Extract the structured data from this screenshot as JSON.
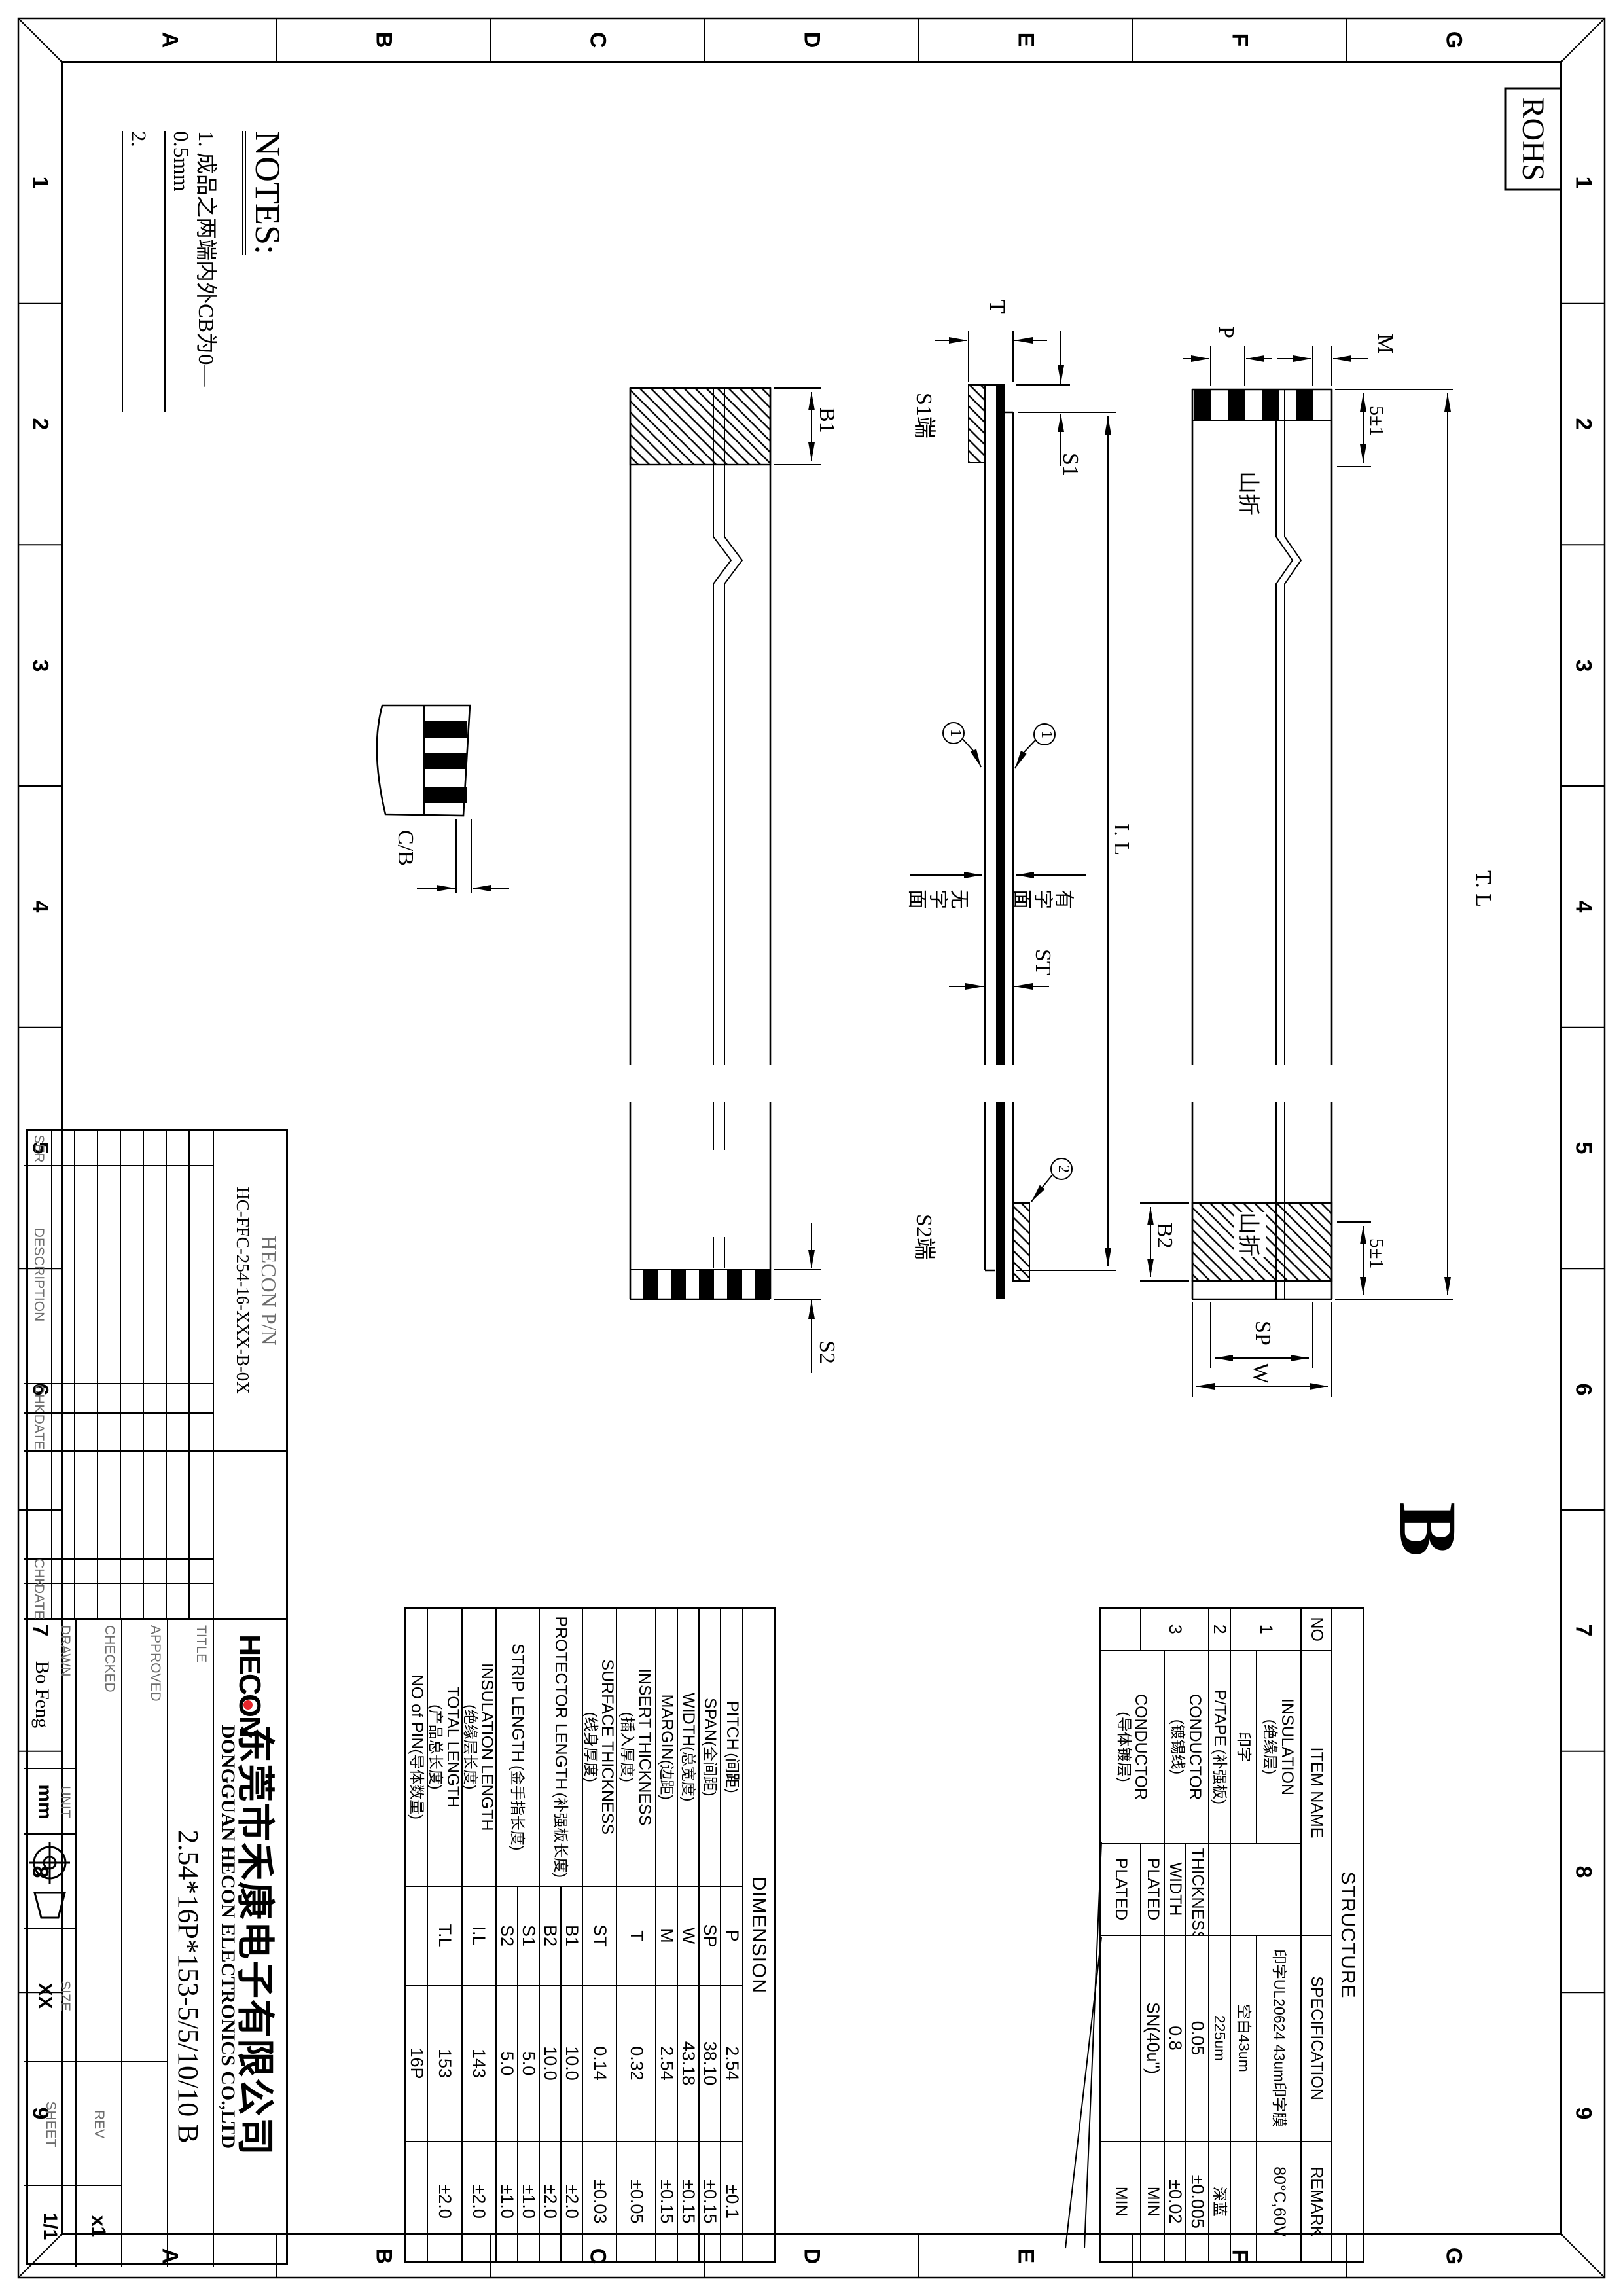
{
  "colors": {
    "line": "#000000",
    "logo_dot": "#e8272d"
  },
  "rohs": "ROHS",
  "rev_marker": "B",
  "frame": {
    "cols": [
      "1",
      "2",
      "3",
      "4",
      "5",
      "6",
      "7",
      "8",
      "9"
    ],
    "rows": [
      "G",
      "F",
      "E",
      "D",
      "C",
      "B",
      "A"
    ]
  },
  "notes": {
    "title": "NOTES:",
    "n1": "1. 成品之两端内外CB为0—0.5mm",
    "n2": "2."
  },
  "ann": {
    "b1": "B1",
    "b2": "B2",
    "s2": "S2",
    "s1": "S1",
    "t": "T",
    "st": "ST",
    "il": "I. L",
    "tl": "T. L",
    "p": "P",
    "m": "M",
    "sp": "SP",
    "w": "W",
    "cb": "C/B",
    "tol5_l": "5±1",
    "tol5_r": "5±1",
    "fold_l": "山折",
    "fold_r": "山折",
    "s1_end": "S1端",
    "s2_end": "S2端",
    "print_side": "有字面",
    "noprint_side": "无字面",
    "balloon_ins_top": "1",
    "balloon_ins_bot": "1",
    "balloon_tape": "2"
  },
  "dim_table": {
    "title": "DIMENSION",
    "rows": [
      {
        "en": "PITCH",
        "cn": "(间距)",
        "sym": "P",
        "val": "2.54",
        "tol": "±0.1"
      },
      {
        "en": "SPAN",
        "cn": "(全间距)",
        "sym": "SP",
        "val": "38.10",
        "tol": "±0.15"
      },
      {
        "en": "WIDTH",
        "cn": "(总宽度)",
        "sym": "W",
        "val": "43.18",
        "tol": "±0.15"
      },
      {
        "en": "MARGIN",
        "cn": "(边距)",
        "sym": "M",
        "val": "2.54",
        "tol": "±0.15"
      },
      {
        "en": "INSERT THICKNESS",
        "cn": "(插入厚度)",
        "sym": "T",
        "val": "0.32",
        "tol": "±0.05"
      },
      {
        "en": "SURFACE THICKNESS",
        "cn": "(线身厚度)",
        "sym": "ST",
        "val": "0.14",
        "tol": "±0.03"
      },
      {
        "en": "PROTECTOR LENGTH",
        "cn": "(补强板长度)",
        "sym": "B1",
        "val": "10.0",
        "tol": "±2.0"
      },
      {
        "en": "",
        "cn": "",
        "sym": "B2",
        "val": "10.0",
        "tol": "±2.0"
      },
      {
        "en": "STRIP LENGTH",
        "cn": "(金手指长度)",
        "sym": "S1",
        "val": "5.0",
        "tol": "±1.0"
      },
      {
        "en": "",
        "cn": "",
        "sym": "S2",
        "val": "5.0",
        "tol": "±1.0"
      },
      {
        "en": "INSULATION LENGTH",
        "cn": "(绝缘层长度)",
        "sym": "I.L",
        "val": "143",
        "tol": "±2.0"
      },
      {
        "en": "TOTAL LENGTH",
        "cn": "(产品总长度)",
        "sym": "T.L",
        "val": "153",
        "tol": "±2.0"
      },
      {
        "en": "NO of PIN",
        "cn": "(导体数量)",
        "sym": "",
        "val": "16P",
        "tol": ""
      }
    ]
  },
  "str_table": {
    "title": "STRUCTURE",
    "h_no": "NO",
    "h_item": "ITEM NAME",
    "h_spec": "SPECIFICATION",
    "h_remark": "REMARK",
    "r1": {
      "no": "1",
      "item_en": "INSULATION",
      "item_cn": "(绝缘层)",
      "spec": "印字UL20624 43um印字膜",
      "remark": "80°C,60V"
    },
    "r2": {
      "item": "印字",
      "spec": "空白43um",
      "remark": ""
    },
    "r3": {
      "no": "2",
      "item_en": "P/TAPE",
      "item_cn": "(补强板)",
      "spec": "225um",
      "remark": "深蓝"
    },
    "r4": {
      "item_en": "CONDUCTOR",
      "item_cn": "(镀锡线)",
      "sub": "THICKNESS",
      "spec": "0.05",
      "remark": "±0.005"
    },
    "r5": {
      "sub": "WIDTH",
      "spec": "0.8",
      "remark": "±0.02"
    },
    "r6": {
      "no": "3",
      "sub": "PLATED",
      "spec": "SN(40u\")",
      "remark": "MIN"
    },
    "r7": {
      "item_en": "CONDUCTOR",
      "item_cn": "(导体镀层)",
      "sub": "PLATED",
      "spec": "",
      "remark": "MIN"
    }
  },
  "title_block": {
    "pn_label": "HECON  P/N",
    "pn": "HC-FFC-254-16-XXX-B-0X",
    "ser": "SER",
    "desc": "DESCRIPTION",
    "chk": "CHK",
    "date": "DATE",
    "chk2": "CHK",
    "date2": "DATE",
    "title_label": "TITLE",
    "approved": "APPROVED",
    "checked": "CHECKED",
    "drawn": "DRAWN",
    "drawn_val": "Bo Feng",
    "unit_label": "UNIT",
    "unit_val": "mm",
    "size_label": "SIZE",
    "size_val": "XX",
    "rev_label": "REV",
    "rev_val": "x1",
    "sheet_label": "SHEET",
    "sheet_val": "1/1",
    "logo": "HECON",
    "company_cn": "东莞市禾康电子有限公司",
    "company_en": "DONGGUAN HECON ELECTRONICS CO.,LTD",
    "title_val": "2.54*16P*153-5/5/10/10 B"
  }
}
